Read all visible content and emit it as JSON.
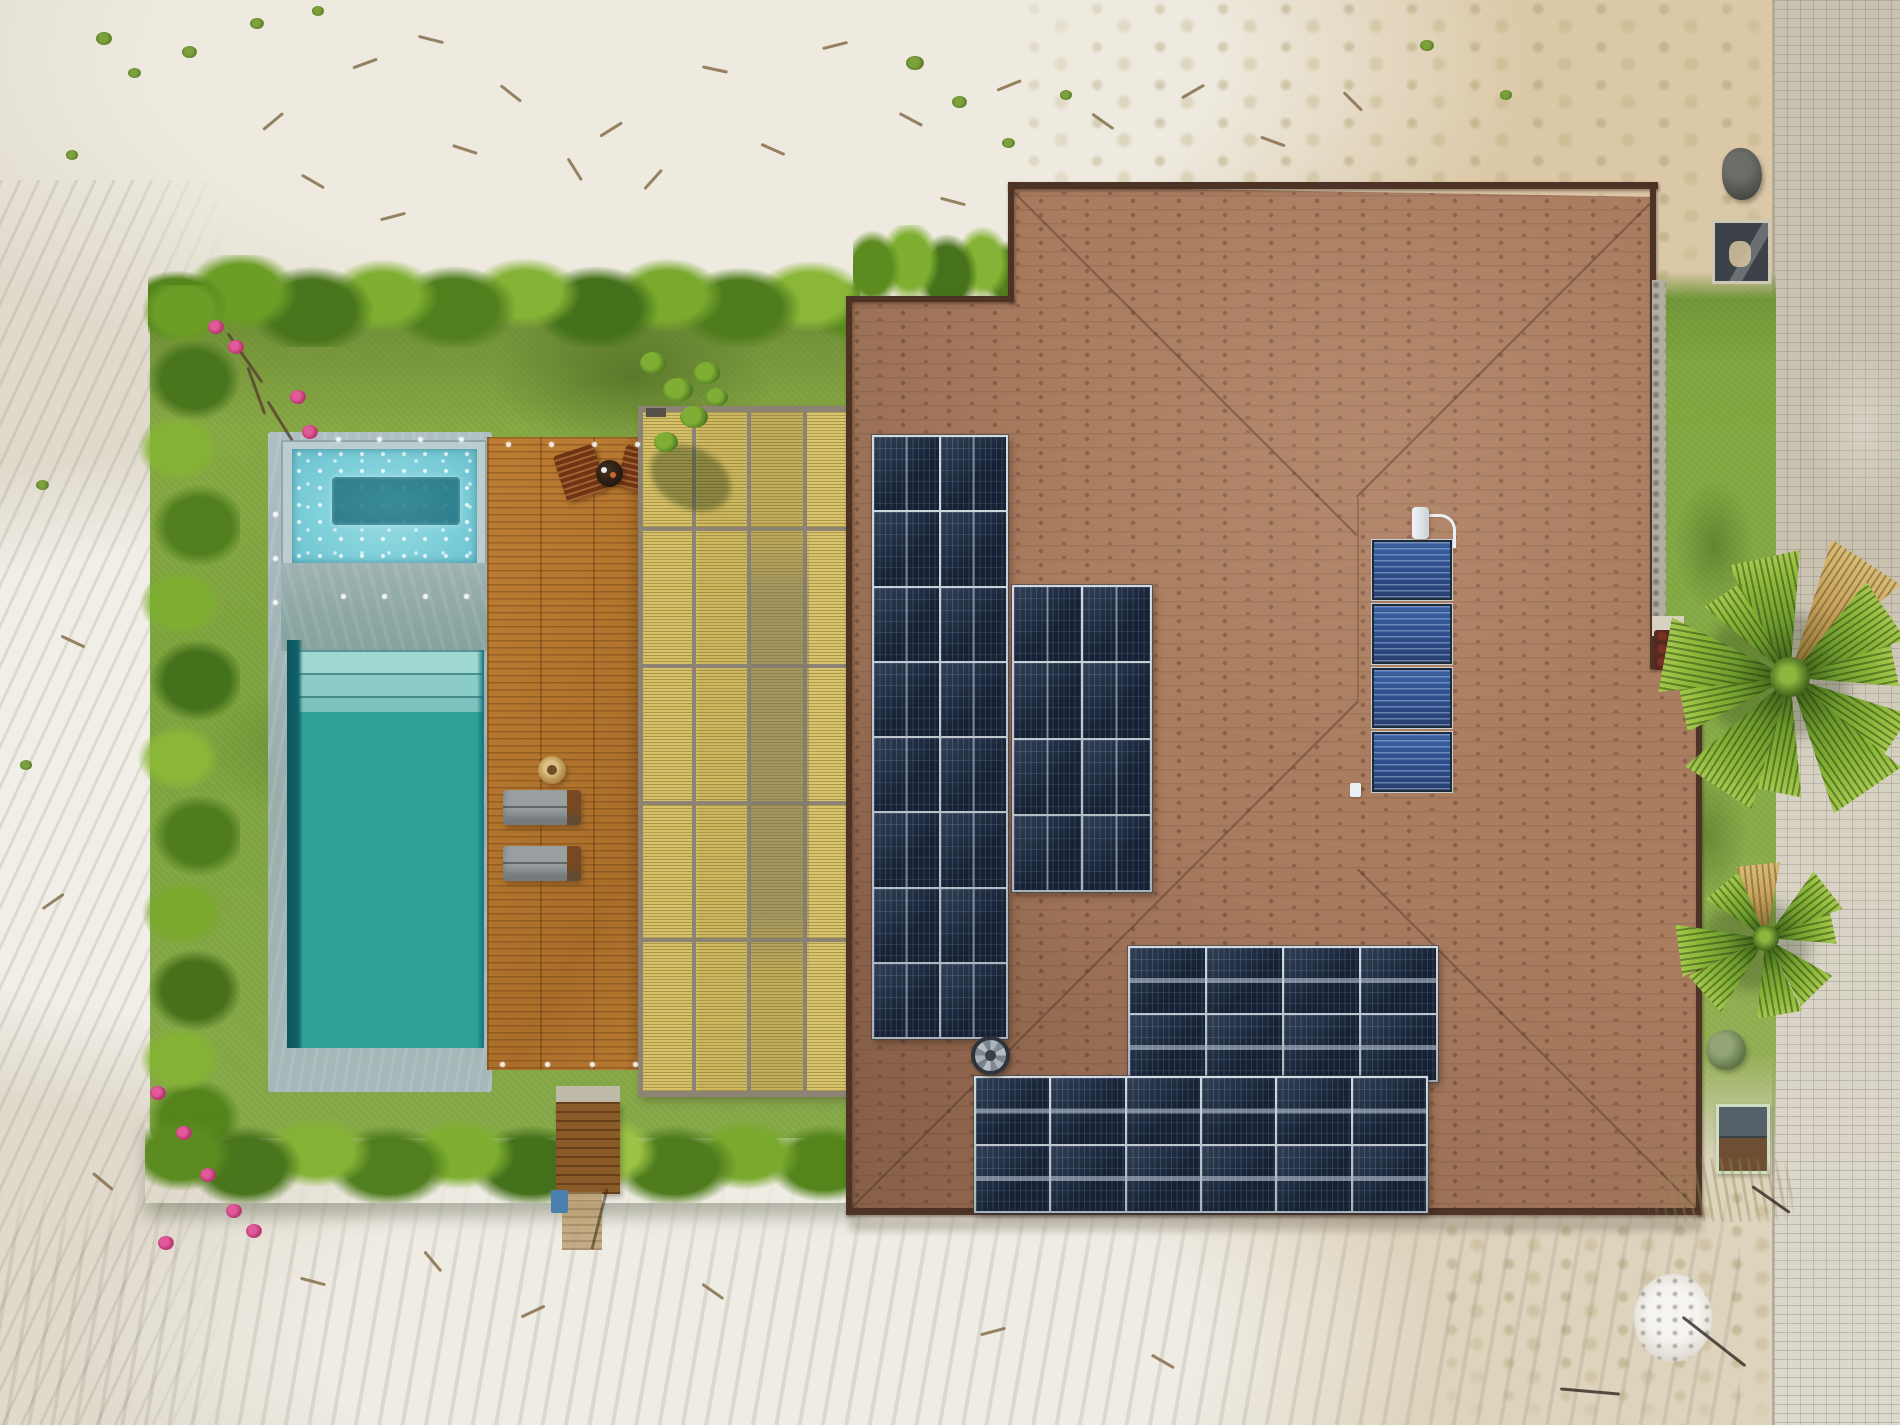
{
  "scene": {
    "title": "Aerial drone view of a tropical house with rooftop solar panels, lap pool with jacuzzi, wooden deck, bamboo pergola, lawn and sand lot beside a paver road",
    "width_px": 1900,
    "height_px": 1425
  },
  "colors": {
    "sand": "#e0dacd",
    "sand-light": "#f1eee7",
    "sand-tan": "#d8c7a6",
    "grass": "#7fa33b",
    "grass-dark": "#5e8230",
    "hedge": "#4f7a28",
    "pool-coping": "#a9babc",
    "pool-water": "#2da195",
    "spa-water": "#7fd0da",
    "deck-wood": "#b4762e",
    "bamboo": "#d2bc62",
    "pergola-frame": "#8d8374",
    "roof-shingle": "#aa7d60",
    "roof-edge": "#4c3326",
    "pv-panel": "#1b2940",
    "pv-frame": "#d3dae0",
    "thermal-blue": "#2d4e8d",
    "road-paver": "#cfc8b9",
    "palm-green": "#7fae35"
  },
  "objects": {
    "roof": {
      "label": "brown shingled hip roof of house"
    },
    "pool": {
      "label": "turquoise lap swimming pool"
    },
    "spa": {
      "label": "bubbling jacuzzi spa"
    },
    "deck": {
      "label": "hardwood pool deck with loungers"
    },
    "pergola": {
      "label": "bamboo-slat pergola roof"
    },
    "lawn": {
      "label": "green lawn bordered by palm hedges"
    },
    "road": {
      "label": "paver sidewalk along right edge"
    },
    "sand": {
      "label": "white sand lot"
    },
    "palm_large": {
      "label": "fan palm tree"
    },
    "palm_small": {
      "label": "small fan palm"
    },
    "vent": {
      "label": "round roof vent fan"
    },
    "water_heater": {
      "label": "solar water heating collectors with pipe and vent"
    }
  },
  "solar": {
    "arrays": {
      "tall": {
        "rows": 8,
        "cols": 2,
        "orientation": "portrait"
      },
      "middle": {
        "rows": 4,
        "cols": 2,
        "orientation": "portrait"
      },
      "bottom_upper": {
        "rows": 2,
        "cols": 4,
        "orientation": "landscape"
      },
      "bottom_lower": {
        "rows": 2,
        "cols": 6,
        "orientation": "landscape"
      },
      "thermal": {
        "panels": 4
      }
    },
    "pv_module_total": 44,
    "thermal_panel_total": 4
  },
  "palms": {
    "large_fronds": 11,
    "small_fronds": 8
  }
}
